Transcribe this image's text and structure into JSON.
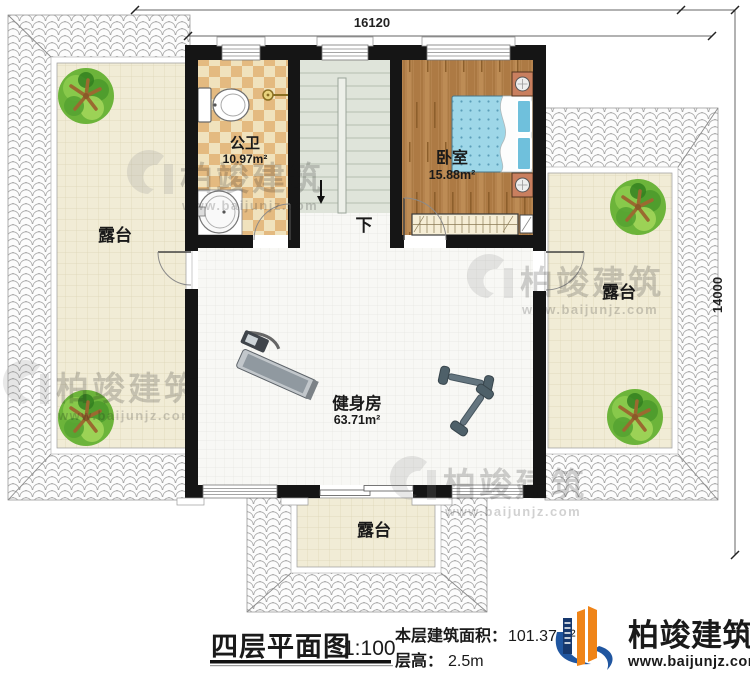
{
  "plan": {
    "title": "四层平面图",
    "scale": "1:100",
    "building_area_label": "本层建筑面积：",
    "building_area_value": "101.37m²",
    "floor_height_label": "层高：",
    "floor_height_value": "2.5m"
  },
  "dimensions": {
    "width_mm": "16120",
    "depth_mm": "14000"
  },
  "rooms": {
    "bathroom": {
      "name": "公卫",
      "area": "10.97m²"
    },
    "bedroom": {
      "name": "卧室",
      "area": "15.88m²"
    },
    "gym": {
      "name": "健身房",
      "area": "63.71m²"
    },
    "stair_direction": "下",
    "terrace_left": "露台",
    "terrace_right": "露台",
    "terrace_bottom": "露台"
  },
  "brand": {
    "name": "柏竣建筑",
    "website": "www.baijunjz.com"
  },
  "watermark": {
    "name": "柏竣建筑",
    "website": "www.baijunjz.com"
  },
  "colors": {
    "wall": "#151515",
    "terrace_floor": "#f1ecd6",
    "bathroom_tile_light": "#f0e2bd",
    "bathroom_tile_dark": "#e4ba80",
    "bedroom_floor": "#b5834e",
    "stair_floor": "#dfe4da",
    "bed": "#9ed7e8",
    "logo_blue": "#2056a0",
    "logo_orange": "#ef8418"
  }
}
